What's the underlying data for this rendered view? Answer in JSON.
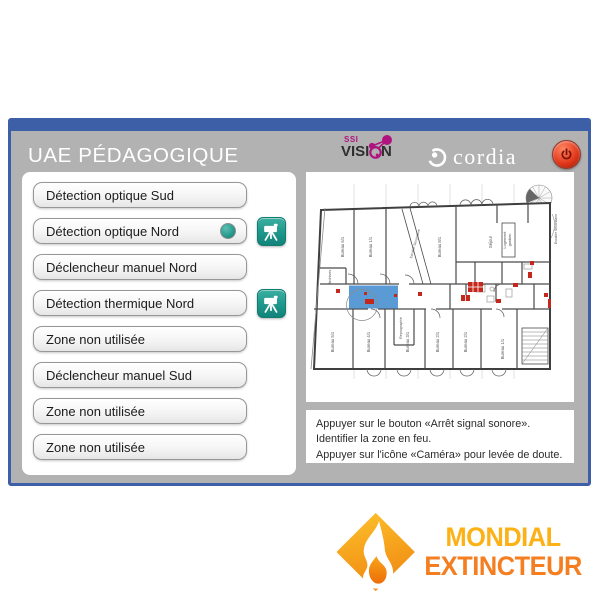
{
  "window": {
    "title": "UAE PÉDAGOGIQUE"
  },
  "logos": {
    "ssi": {
      "top": "SSI",
      "main": "VISION"
    },
    "cordia": "cordia"
  },
  "zones": [
    {
      "label": "Détection optique Sud",
      "active": false,
      "camera": false
    },
    {
      "label": "Détection optique Nord",
      "active": true,
      "camera": true
    },
    {
      "label": "Déclencheur manuel Nord",
      "active": false,
      "camera": false
    },
    {
      "label": "Détection thermique Nord",
      "active": false,
      "camera": true
    },
    {
      "label": "Zone non utilisée",
      "active": false,
      "camera": false
    },
    {
      "label": "Déclencheur manuel Sud",
      "active": false,
      "camera": false
    },
    {
      "label": "Zone non utilisée",
      "active": false,
      "camera": false
    },
    {
      "label": "Zone non utilisée",
      "active": false,
      "camera": false
    }
  ],
  "instructions": {
    "line1": "Appuyer sur le bouton «Arrêt signal sonore».",
    "line2": "Identifier la zone en feu.",
    "line3": "Appuyer sur l'icône «Caméra» pour levée de doute."
  },
  "plan": {
    "room_labels": [
      "Bureau 6/1",
      "Bureau 1/1",
      "Bureau 8/1",
      "Séjour",
      "Logement",
      "gardien",
      "Archives",
      "Reprographie",
      "Bureau 5/1",
      "Bureau 4/1",
      "Bureau 3/1",
      "Bureau 2/1",
      "Bureau 2/1",
      "Bureau 1/1",
      "Escalier Secondaire",
      "Escalier Secondaire"
    ],
    "highlight_color": "#5b9bd5",
    "alarm_color": "#c4281c"
  },
  "brand": {
    "line1": "MONDIAL",
    "line2": "EXTINCTEUR",
    "color1": "#fcb116",
    "color2": "#f57e20"
  },
  "colors": {
    "window_border_blue": "#3d5fa8",
    "window_gray": "#b2b2b2",
    "teal": "#1f998c",
    "power_red": "#e23a1c"
  }
}
